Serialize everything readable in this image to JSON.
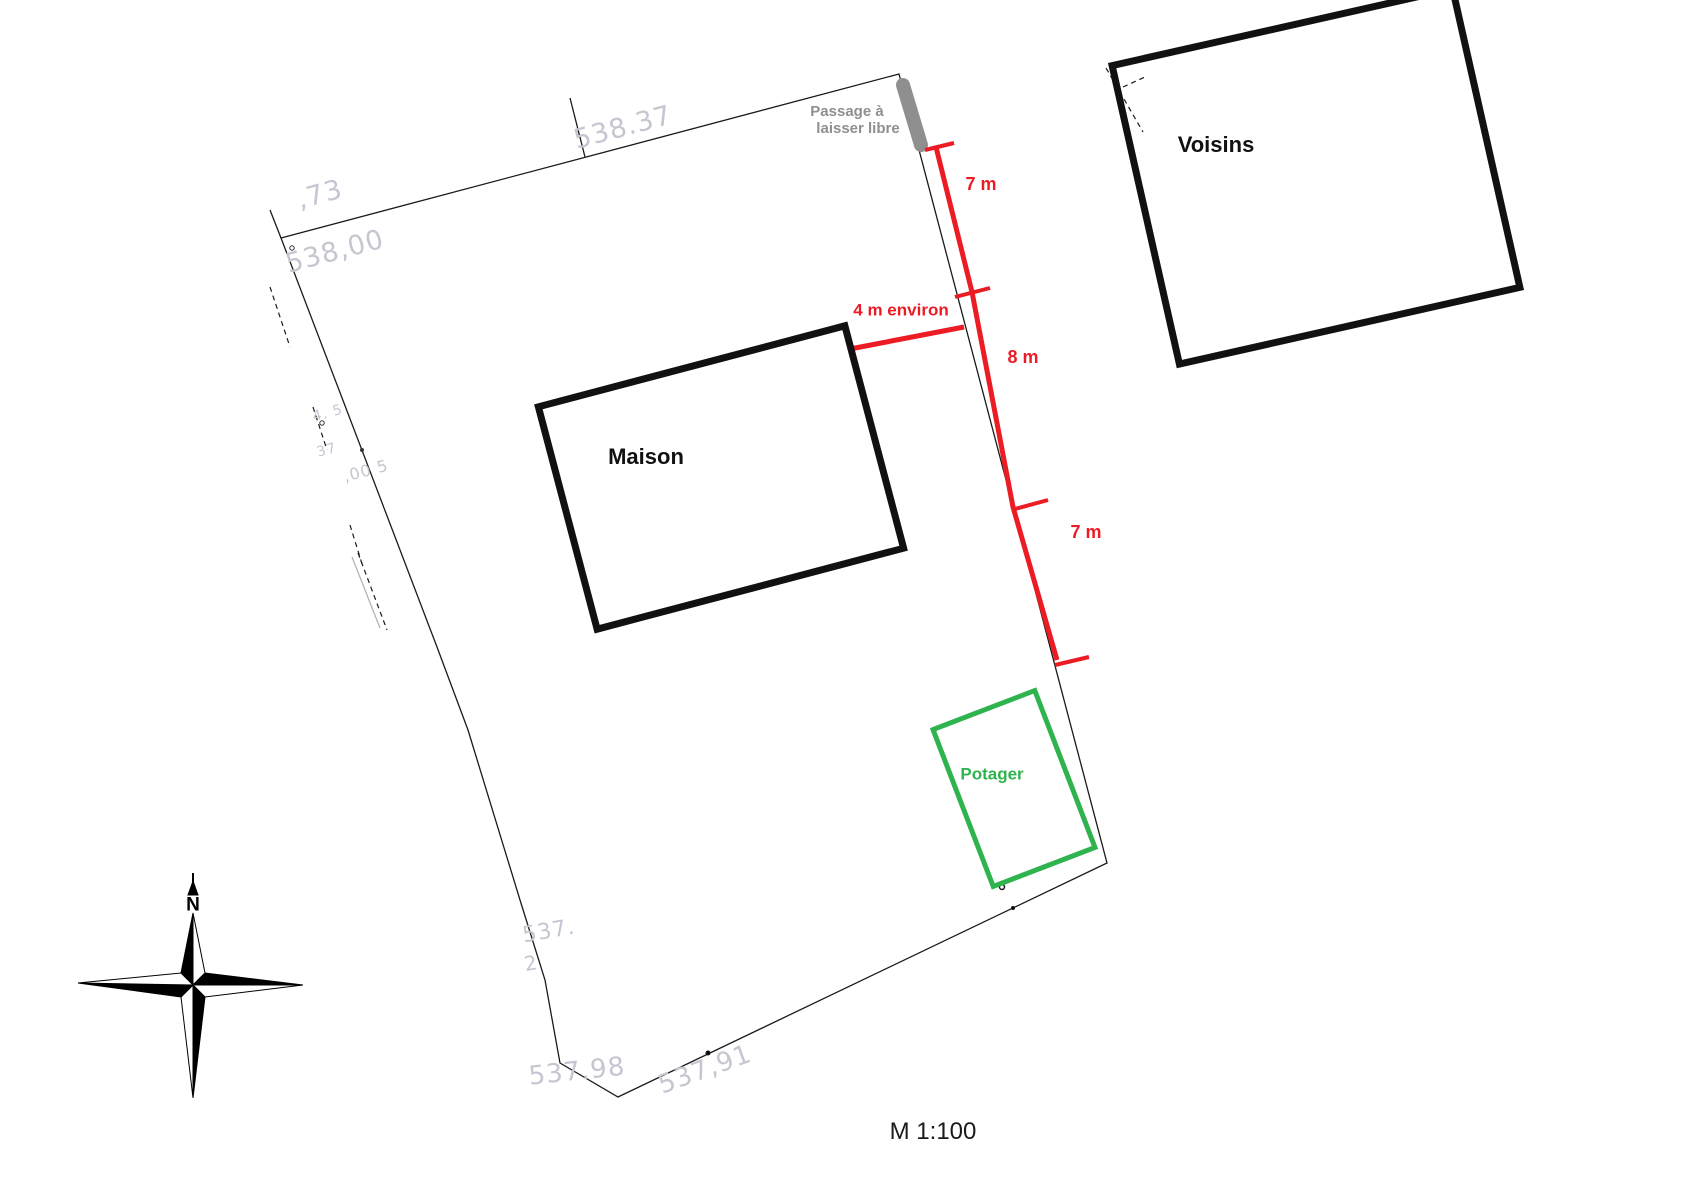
{
  "scale_label": "M 1:100",
  "compass": {
    "north_label": "N"
  },
  "buildings": {
    "maison": {
      "label": "Maison"
    },
    "voisins": {
      "label": "Voisins"
    },
    "potager": {
      "label": "Potager"
    }
  },
  "passage": {
    "line1": "Passage à",
    "line2": "laisser libre"
  },
  "dimensions": {
    "top_segment": "7 m",
    "middle_segment": "8 m",
    "bottom_segment": "7 m",
    "house_to_boundary": "4 m environ"
  },
  "elevations": [
    {
      "text": "538.37"
    },
    {
      "text": ",73"
    },
    {
      "text": "538,00"
    },
    {
      "text": "4. 5"
    },
    {
      "text": "37"
    },
    {
      "text": ",00 5"
    },
    {
      "text": "537."
    },
    {
      "text": "2"
    },
    {
      "text": "537.98"
    },
    {
      "text": "537,91"
    }
  ],
  "colors": {
    "dimension_red": "#EC1C24",
    "potager_green": "#2FB34F",
    "passage_gray": "#8F8F8F",
    "elevation_gray": "#C6C6D2",
    "line_black": "#1A1A1A"
  }
}
